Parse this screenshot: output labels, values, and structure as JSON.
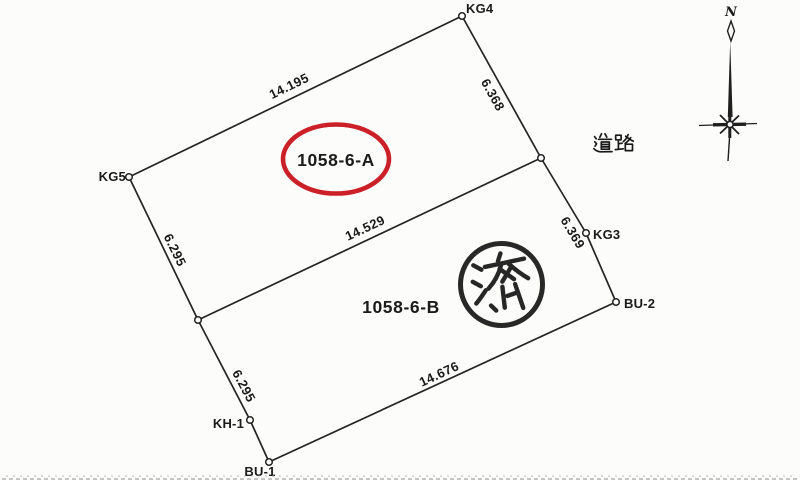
{
  "drawing": {
    "parcels": {
      "a_label": "1058-6-A",
      "b_label": "1058-6-B"
    },
    "road_label": "道路",
    "stamp_label": "済",
    "compass_north_label": "N",
    "points": {
      "kg4": "KG4",
      "kg5": "KG5",
      "kg3": "KG3",
      "bu2": "BU-2",
      "bu1": "BU-1",
      "kh1": "KH-1"
    },
    "dimensions": {
      "top_edge": "14.195",
      "divider": "14.529",
      "bottom_edge": "14.676",
      "right_upper": "6.368",
      "right_lower": "6.369",
      "left_upper": "6.295",
      "left_lower": "6.295"
    },
    "colors": {
      "ink": "#1e1e1e",
      "highlight_red": "#cc2028",
      "paper": "#fcfcfa"
    }
  }
}
